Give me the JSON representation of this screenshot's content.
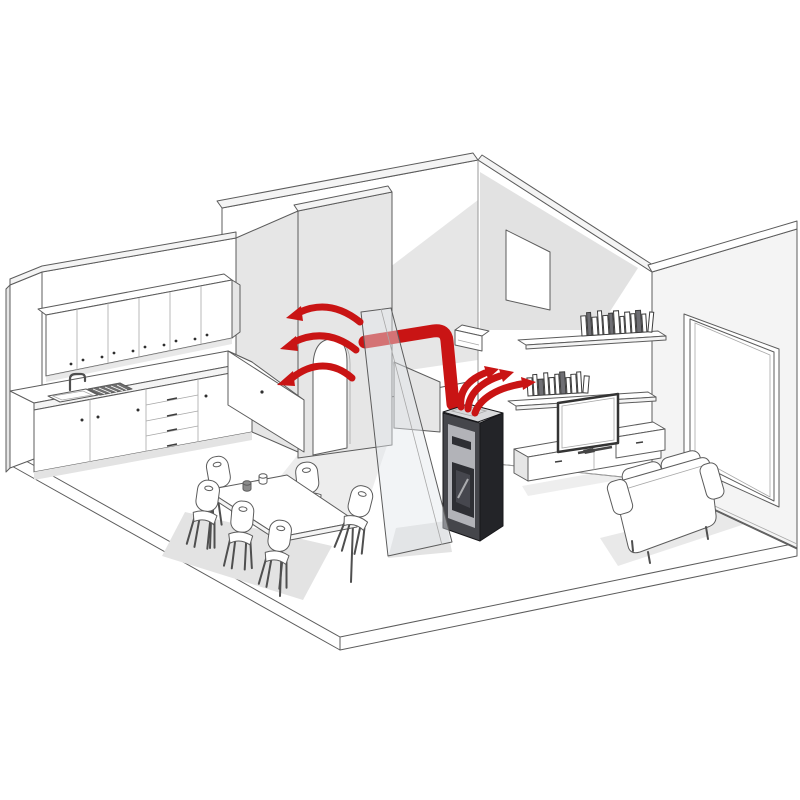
{
  "diagram": {
    "label": "Isometric cutaway of an apartment showing a pellet stove distributing warm air: directly into the living room and through a red duct in the wall to the kitchen and dining area",
    "type": "isometric-cutaway-illustration",
    "background": "#ffffff"
  },
  "colors": {
    "accent_red": "#c91414",
    "line": "#5c5c5c",
    "wall_white": "#fdfdfd",
    "wall_gray": "#e6e6e6",
    "wall_shadow": "#d8d8d8",
    "floor_shadow": "#e3e3e3",
    "stove_side_dark": "#232428",
    "stove_front_frame": "#45464b",
    "stove_panel_light": "#b2b3b8",
    "stove_door_dark": "#2e2f34",
    "stove_glass": "#46474e",
    "stove_top": "#d8d9db",
    "window_frame_khaki": "#9a9870",
    "glass_tint": "rgba(226,230,236,0.45)"
  },
  "airflow": {
    "description": "Warm air ducted from stove through wall, exiting above the arched doorway toward the dining/kitchen area; stove also blows warm air directly into the living room",
    "duct_outlet_arrows": 3,
    "stove_front_arrows": 3
  },
  "rooms": {
    "kitchen": {
      "items": [
        "upper-cabinet-row-6-doors",
        "sink-with-faucet-and-drainboard",
        "l-shaped-base-cabinets",
        "drawer-stack-4"
      ]
    },
    "dining": {
      "items": [
        "rectangular-table",
        "chairs-x6",
        "cups-x2"
      ]
    },
    "hallway": {
      "items": [
        "arched-doorway",
        "portrait-window",
        "open-door-panel",
        "glass-partition"
      ]
    },
    "living_room": {
      "items": [
        "pellet-stove",
        "book-shelf-upper",
        "book-shelf-lower",
        "tv-on-media-bench",
        "low-wall-cabinet",
        "two-seat-sofa",
        "large-picture-window",
        "doorway-opening"
      ]
    }
  },
  "counts": {
    "chairs": 6,
    "upper_cabinet_doors": 6,
    "base_cabinet_doors": 4,
    "drawers": 4,
    "shelves": 2,
    "books_upper_shelf": 13,
    "books_lower_shelf": 11,
    "windows": 2,
    "red_arrows_total": 6,
    "cups_on_table": 2
  }
}
